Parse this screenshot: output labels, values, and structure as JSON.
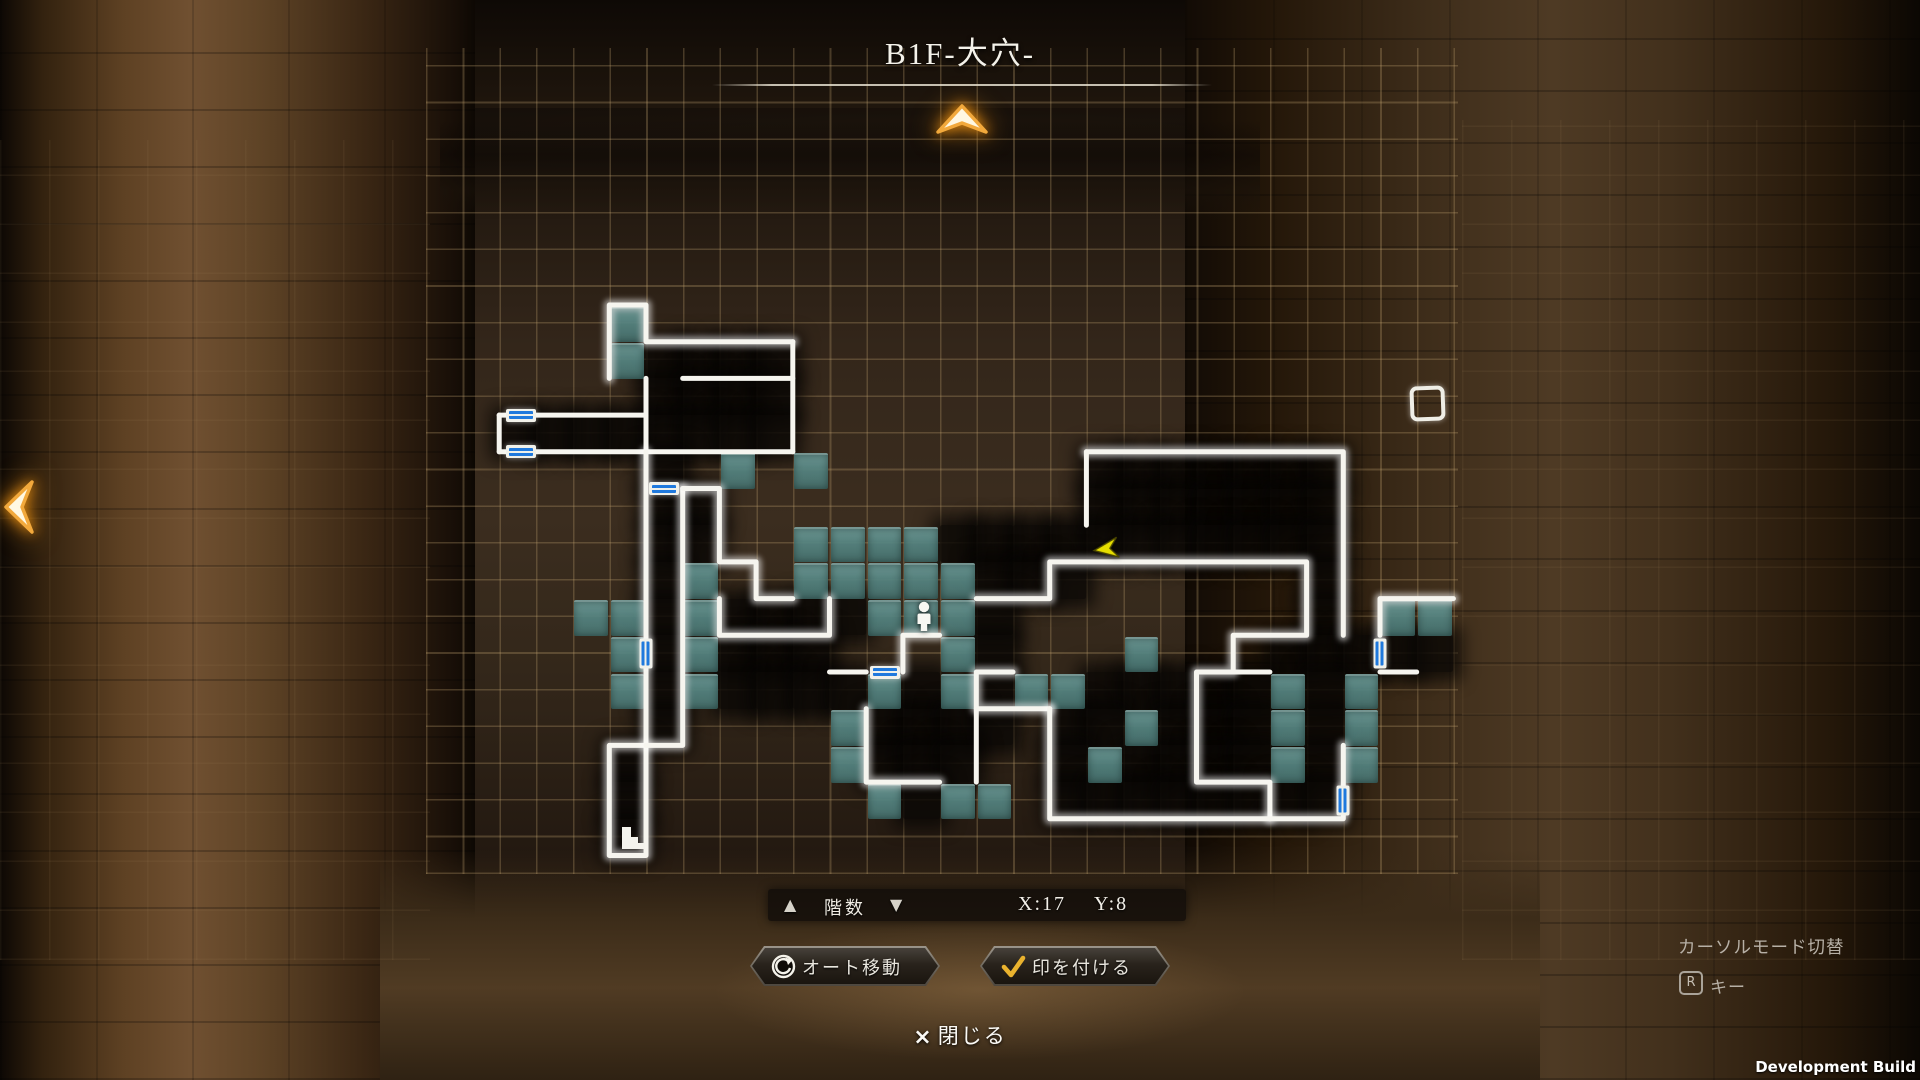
{
  "title": "B1F-大穴-",
  "map": {
    "grid": {
      "cols": 27,
      "rows": 17,
      "cell": 36.7,
      "origin_x": 462.5,
      "origin_y": 231.6
    },
    "teal_cells": [
      [
        4,
        2
      ],
      [
        4,
        3
      ],
      [
        7,
        6
      ],
      [
        9,
        6
      ],
      [
        9,
        8
      ],
      [
        10,
        8
      ],
      [
        11,
        8
      ],
      [
        12,
        8
      ],
      [
        9,
        9
      ],
      [
        10,
        9
      ],
      [
        11,
        9
      ],
      [
        12,
        9
      ],
      [
        13,
        9
      ],
      [
        3,
        10
      ],
      [
        4,
        10
      ],
      [
        6,
        9
      ],
      [
        6,
        10
      ],
      [
        11,
        10
      ],
      [
        12,
        10
      ],
      [
        13,
        10
      ],
      [
        25,
        10
      ],
      [
        26,
        10
      ],
      [
        4,
        11
      ],
      [
        6,
        11
      ],
      [
        13,
        11
      ],
      [
        18,
        11
      ],
      [
        4,
        12
      ],
      [
        6,
        12
      ],
      [
        11,
        12
      ],
      [
        13,
        12
      ],
      [
        15,
        12
      ],
      [
        16,
        12
      ],
      [
        22,
        12
      ],
      [
        24,
        12
      ],
      [
        10,
        13
      ],
      [
        18,
        13
      ],
      [
        22,
        13
      ],
      [
        24,
        13
      ],
      [
        10,
        14
      ],
      [
        17,
        14
      ],
      [
        22,
        14
      ],
      [
        24,
        14
      ],
      [
        11,
        15
      ],
      [
        13,
        15
      ],
      [
        14,
        15
      ]
    ],
    "explored_cells": [
      [
        5,
        3
      ],
      [
        6,
        3
      ],
      [
        7,
        3
      ],
      [
        8,
        3
      ],
      [
        5,
        4
      ],
      [
        6,
        4
      ],
      [
        7,
        4
      ],
      [
        8,
        4
      ],
      [
        1,
        5
      ],
      [
        2,
        5
      ],
      [
        3,
        5
      ],
      [
        4,
        5
      ],
      [
        5,
        5
      ],
      [
        6,
        5
      ],
      [
        7,
        5
      ],
      [
        8,
        5
      ],
      [
        5,
        6
      ],
      [
        17,
        6
      ],
      [
        18,
        6
      ],
      [
        19,
        6
      ],
      [
        20,
        6
      ],
      [
        21,
        6
      ],
      [
        22,
        6
      ],
      [
        23,
        6
      ],
      [
        5,
        7
      ],
      [
        6,
        7
      ],
      [
        17,
        7
      ],
      [
        18,
        7
      ],
      [
        19,
        7
      ],
      [
        20,
        7
      ],
      [
        21,
        7
      ],
      [
        22,
        7
      ],
      [
        23,
        7
      ],
      [
        5,
        8
      ],
      [
        6,
        8
      ],
      [
        13,
        8
      ],
      [
        14,
        8
      ],
      [
        15,
        8
      ],
      [
        16,
        8
      ],
      [
        17,
        8
      ],
      [
        18,
        8
      ],
      [
        19,
        8
      ],
      [
        20,
        8
      ],
      [
        21,
        8
      ],
      [
        22,
        8
      ],
      [
        23,
        8
      ],
      [
        5,
        9
      ],
      [
        14,
        9
      ],
      [
        15,
        9
      ],
      [
        16,
        9
      ],
      [
        23,
        9
      ],
      [
        5,
        10
      ],
      [
        7,
        10
      ],
      [
        8,
        10
      ],
      [
        9,
        10
      ],
      [
        10,
        10
      ],
      [
        14,
        10
      ],
      [
        23,
        10
      ],
      [
        5,
        11
      ],
      [
        7,
        11
      ],
      [
        8,
        11
      ],
      [
        9,
        11
      ],
      [
        14,
        11
      ],
      [
        22,
        11
      ],
      [
        23,
        11
      ],
      [
        24,
        11
      ],
      [
        25,
        11
      ],
      [
        26,
        11
      ],
      [
        5,
        12
      ],
      [
        7,
        12
      ],
      [
        8,
        12
      ],
      [
        9,
        12
      ],
      [
        10,
        12
      ],
      [
        12,
        12
      ],
      [
        14,
        12
      ],
      [
        17,
        12
      ],
      [
        18,
        12
      ],
      [
        19,
        12
      ],
      [
        20,
        12
      ],
      [
        21,
        12
      ],
      [
        23,
        12
      ],
      [
        5,
        13
      ],
      [
        11,
        13
      ],
      [
        12,
        13
      ],
      [
        13,
        13
      ],
      [
        14,
        13
      ],
      [
        16,
        13
      ],
      [
        17,
        13
      ],
      [
        19,
        13
      ],
      [
        20,
        13
      ],
      [
        21,
        13
      ],
      [
        23,
        13
      ],
      [
        4,
        14
      ],
      [
        11,
        14
      ],
      [
        12,
        14
      ],
      [
        13,
        14
      ],
      [
        16,
        14
      ],
      [
        18,
        14
      ],
      [
        19,
        14
      ],
      [
        20,
        14
      ],
      [
        21,
        14
      ],
      [
        23,
        14
      ],
      [
        4,
        15
      ],
      [
        12,
        15
      ],
      [
        16,
        15
      ],
      [
        17,
        15
      ],
      [
        18,
        15
      ],
      [
        19,
        15
      ],
      [
        20,
        15
      ],
      [
        21,
        15
      ],
      [
        22,
        15
      ],
      [
        23,
        15
      ],
      [
        4,
        16
      ]
    ],
    "walls": [
      [
        [
          4,
          4
        ],
        [
          4,
          2
        ],
        [
          5,
          2
        ],
        [
          5,
          3
        ],
        [
          9,
          3
        ]
      ],
      [
        [
          6,
          4
        ],
        [
          9,
          4
        ]
      ],
      [
        [
          9,
          3
        ],
        [
          9,
          6
        ]
      ],
      [
        [
          1,
          5
        ],
        [
          5,
          5
        ]
      ],
      [
        [
          1,
          5
        ],
        [
          1,
          6
        ]
      ],
      [
        [
          1,
          6
        ],
        [
          9,
          6
        ]
      ],
      [
        [
          5,
          4
        ],
        [
          5,
          6
        ]
      ],
      [
        [
          5,
          6
        ],
        [
          5,
          14
        ],
        [
          4,
          14
        ],
        [
          4,
          17
        ],
        [
          5,
          17
        ],
        [
          5,
          14
        ]
      ],
      [
        [
          6,
          7
        ],
        [
          6,
          14
        ],
        [
          5,
          14
        ]
      ],
      [
        [
          6,
          7
        ],
        [
          7,
          7
        ],
        [
          7,
          9
        ],
        [
          8,
          9
        ],
        [
          8,
          10
        ],
        [
          9,
          10
        ]
      ],
      [
        [
          7,
          10
        ],
        [
          7,
          11
        ],
        [
          10,
          11
        ],
        [
          10,
          10
        ]
      ],
      [
        [
          10,
          12
        ],
        [
          11,
          12
        ]
      ],
      [
        [
          12,
          12
        ],
        [
          12,
          11
        ],
        [
          13,
          11
        ]
      ],
      [
        [
          15,
          12
        ],
        [
          14,
          12
        ],
        [
          14,
          13
        ],
        [
          16,
          13
        ]
      ],
      [
        [
          11,
          13
        ],
        [
          11,
          15
        ],
        [
          13,
          15
        ]
      ],
      [
        [
          14,
          13
        ],
        [
          14,
          15
        ]
      ],
      [
        [
          14,
          10
        ],
        [
          16,
          10
        ],
        [
          16,
          9
        ],
        [
          23,
          9
        ],
        [
          23,
          11
        ],
        [
          21,
          11
        ],
        [
          21,
          12
        ],
        [
          20,
          12
        ],
        [
          20,
          15
        ],
        [
          22,
          15
        ],
        [
          22,
          16
        ]
      ],
      [
        [
          21,
          12
        ],
        [
          22,
          12
        ]
      ],
      [
        [
          16,
          13
        ],
        [
          16,
          16
        ],
        [
          24,
          16
        ],
        [
          24,
          14
        ]
      ],
      [
        [
          17,
          6
        ],
        [
          24,
          6
        ],
        [
          24,
          11
        ]
      ],
      [
        [
          17,
          6
        ],
        [
          17,
          8
        ]
      ],
      [
        [
          25,
          11
        ],
        [
          25,
          10
        ],
        [
          27,
          10
        ]
      ],
      [
        [
          25,
          12
        ],
        [
          26,
          12
        ]
      ]
    ],
    "doors": [
      {
        "x": 1.6,
        "y": 5,
        "o": "h"
      },
      {
        "x": 1.6,
        "y": 6,
        "o": "h"
      },
      {
        "x": 5.5,
        "y": 7,
        "o": "h"
      },
      {
        "x": 5,
        "y": 11.5,
        "o": "v"
      },
      {
        "x": 11.5,
        "y": 12,
        "o": "h"
      },
      {
        "x": 25,
        "y": 11.5,
        "o": "v"
      },
      {
        "x": 24,
        "y": 15.5,
        "o": "v"
      }
    ],
    "player": {
      "x": 12,
      "y": 10,
      "dx": 3,
      "dy": 0
    },
    "cursor": {
      "x": 17,
      "y": 8,
      "dx": 0,
      "dy": 5
    },
    "marker": {
      "x": 26,
      "y": 4,
      "dx": -8,
      "dy": 7
    },
    "stairs": {
      "x": 4,
      "y": 16,
      "dx": 6,
      "dy": -1
    },
    "colors": {
      "teal": "#5f8f8c",
      "explored": "rgba(10,7,5,0.82)",
      "wall": "#f6f5ef",
      "door_blue": "#1f79dd",
      "cursor_yellow": "#e6de00",
      "gold": "#f0a93c",
      "grid_line": "#bc9e6c"
    }
  },
  "floor_bar": {
    "up_icon": "▲",
    "label": "階数",
    "down_icon": "▼",
    "coord_x": "X:17",
    "coord_y": "Y:8"
  },
  "actions": {
    "auto_move": "オート移動",
    "mark": "印を付ける"
  },
  "close": {
    "icon": "×",
    "label": "閉じる"
  },
  "hint": {
    "line1": "カーソルモード切替",
    "key": "R",
    "key_suffix": "キー"
  },
  "build": "Development Build"
}
